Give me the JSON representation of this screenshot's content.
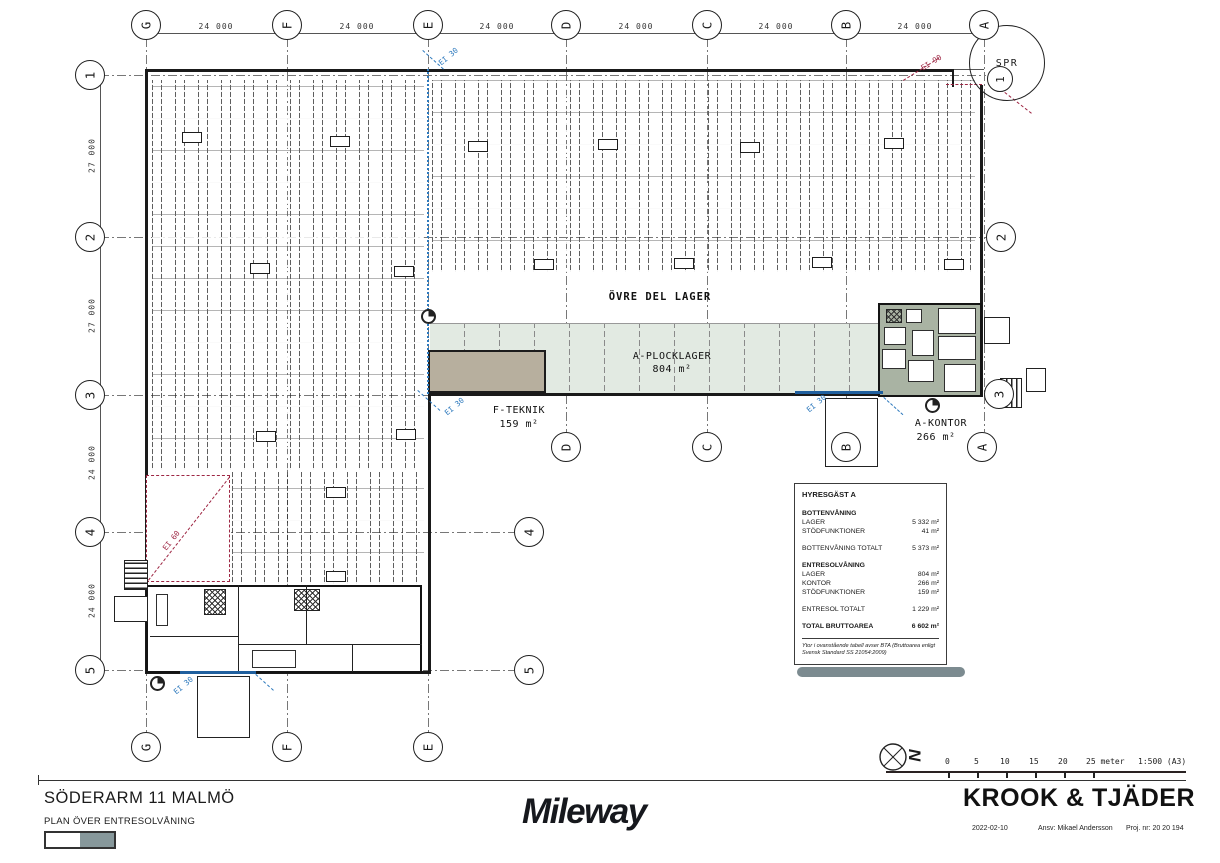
{
  "sheet": {
    "project_title": "SÖDERARM 11 MALMÖ",
    "drawing_title": "PLAN ÖVER ENTRESOLVÅNING",
    "logo": "Mileway",
    "firm": "KROOK & TJÄDER",
    "date": "2022-02-10",
    "responsible": "Ansv: Mikael Andersson",
    "project_number": "Proj. nr: 20 20 194",
    "scale_unit": "25 meter",
    "scale_ratio": "1:500 (A3)",
    "scale_ticks": [
      "0",
      "5",
      "10",
      "15",
      "20"
    ],
    "north": "N"
  },
  "plan": {
    "grid": {
      "columns": [
        "G",
        "F",
        "E",
        "D",
        "C",
        "B",
        "A"
      ],
      "rows": [
        "1",
        "2",
        "3",
        "4",
        "5"
      ],
      "col_spacing": "24 000",
      "row_spacings": [
        "27 000",
        "27 000",
        "24 000",
        "24 000"
      ]
    },
    "labels": {
      "upper_storage": "ÖVRE DEL LAGER",
      "picking_name": "A-PLOCKLAGER",
      "picking_area": "804 m²",
      "tech_name": "F-TEKNIK",
      "tech_area": "159 m²",
      "office_name": "A-KONTOR",
      "office_area": "266 m²",
      "sprinkler": "SPR",
      "detail_ref": "1"
    },
    "fire": {
      "ei30": "EI 30",
      "ei60": "EI 60",
      "ei90": "EI 90"
    },
    "colors": {
      "picking_strip": "#e2eae2",
      "tech_block": "#b7af9e",
      "office_fill": "#a9b3a3",
      "fire_red": "#9e2643",
      "fire_blue": "#2d79bd"
    }
  },
  "area_table": {
    "title": "HYRESGÄST A",
    "rows": [
      {
        "label": "BOTTENVÅNING",
        "value": ""
      },
      {
        "label": "LAGER",
        "value": "5 332 m²"
      },
      {
        "label": "STÖDFUNKTIONER",
        "value": "41 m²"
      },
      {
        "label": "BOTTENVÅNING TOTALT",
        "value": "5 373 m²"
      },
      {
        "label": "ENTRESOLVÅNING",
        "value": ""
      },
      {
        "label": "LAGER",
        "value": "804 m²"
      },
      {
        "label": "KONTOR",
        "value": "266 m²"
      },
      {
        "label": "STÖDFUNKTIONER",
        "value": "159 m²"
      },
      {
        "label": "ENTRESOL TOTALT",
        "value": "1 229 m²"
      },
      {
        "label": "TOTAL BRUTTOAREA",
        "value": "6 602 m²"
      }
    ],
    "footnote": "Ytor i ovanstående tabell avser BTA (Bruttoarea enligt Svensk Standard SS 21054:2009)"
  }
}
